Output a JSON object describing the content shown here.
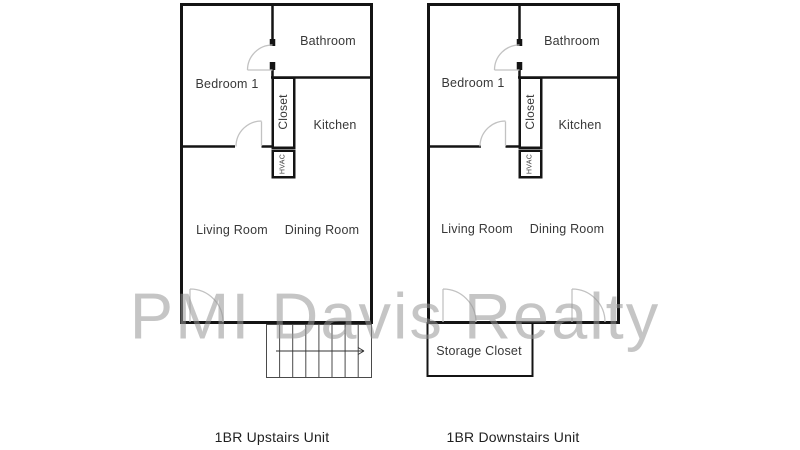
{
  "watermark": {
    "text": "PMI Davis Realty",
    "color": "#c6c6c6"
  },
  "colors": {
    "wall": "#141414",
    "door_arc": "#c2c2c2",
    "label": "#383838",
    "stair_line": "#4a4a4a",
    "background": "#ffffff"
  },
  "units": [
    {
      "caption": "1BR Upstairs Unit",
      "rooms": {
        "bathroom": "Bathroom",
        "bedroom": "Bedroom 1",
        "closet": "Closet",
        "kitchen": "Kitchen",
        "hvac": "HVAC",
        "living": "Living Room",
        "dining": "Dining Room"
      }
    },
    {
      "caption": "1BR Downstairs Unit",
      "rooms": {
        "bathroom": "Bathroom",
        "bedroom": "Bedroom 1",
        "closet": "Closet",
        "kitchen": "Kitchen",
        "hvac": "HVAC",
        "living": "Living Room",
        "dining": "Dining Room",
        "storage": "Storage Closet"
      }
    }
  ]
}
